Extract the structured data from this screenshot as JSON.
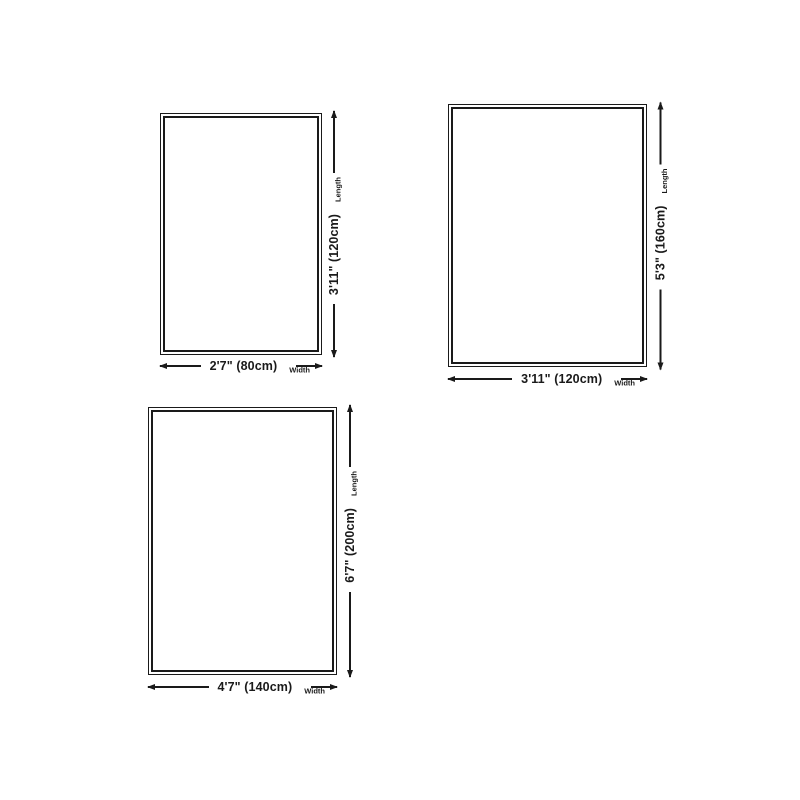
{
  "colors": {
    "background": "#ffffff",
    "line": "#1a1a1a"
  },
  "diagram": {
    "description": "Rug size guide with three rectangles showing width and length dimensions",
    "rects": [
      {
        "width_text": "2'7\" (80cm)",
        "length_text": "3'11\" (120cm)",
        "width_caption": "Width",
        "length_caption": "Length"
      },
      {
        "width_text": "3'11\" (120cm)",
        "length_text": "5'3\" (160cm)",
        "width_caption": "Width",
        "length_caption": "Length"
      },
      {
        "width_text": "4'7\" (140cm)",
        "length_text": "6'7\" (200cm)",
        "width_caption": "Width",
        "length_caption": "Length"
      }
    ]
  }
}
